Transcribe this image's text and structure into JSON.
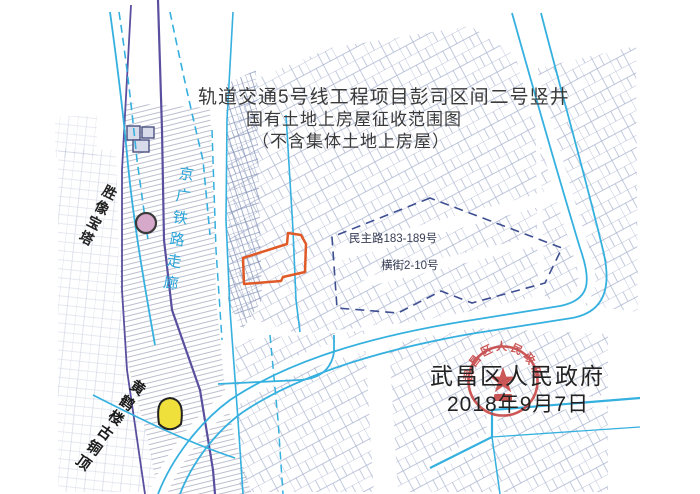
{
  "title": {
    "line1": "轨道交通5号线工程项目彭司区间二号竖井",
    "line2": "国有土地上房屋征收范围图",
    "line3": "（不含集体土地上房屋）"
  },
  "stamp": {
    "authority": "武昌区人民政府",
    "date": "2018年9月7日",
    "seal_text": "武昌区人民政府"
  },
  "map_labels": {
    "road_range": "民主路183-189号",
    "street_range": "横街2-10号",
    "pagoda": "胜像宝塔",
    "railway_corridor": "京广铁路走廊",
    "bronze_top": "黄鹤楼古铜顶"
  },
  "colors": {
    "expropriation_boundary": "#e05a28",
    "road_line": "#35b0df",
    "railway_boundary": "#5a4f9e",
    "seal_red": "#c43b3b",
    "parcel_line": "#9aa6c6"
  }
}
